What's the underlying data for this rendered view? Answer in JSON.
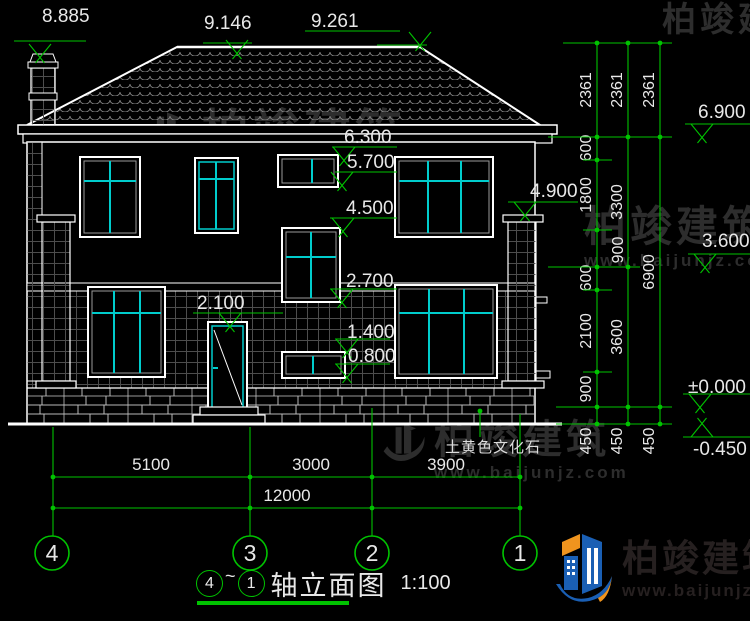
{
  "watermark": {
    "name": "柏竣建筑",
    "url": "www.baijunjz.com"
  },
  "logo": {
    "name": "柏竣建筑",
    "url": "www.baijunjz.com"
  },
  "title_block": {
    "axis_from": "4",
    "tilde": "~",
    "axis_to": "1",
    "title": "轴立面图",
    "scale": "1:100"
  },
  "material_label": {
    "text": "土黄色文化石"
  },
  "colors": {
    "dim_green": "#00c300",
    "line_white": "#e8e8e8",
    "window_cyan": "#00cccc",
    "logo_blue": "#1a5fb4",
    "logo_orange": "#f0941e"
  },
  "annotations": {
    "elevation_markers": [
      {
        "t": "8.885",
        "tx": 42,
        "ty": 6,
        "line": [
          14,
          86,
          41
        ],
        "apex": [
          40,
          57
        ]
      },
      {
        "t": "9.146",
        "tx": 204,
        "ty": 13,
        "line": [
          203,
          252,
          43
        ],
        "apex": [
          237,
          53
        ]
      },
      {
        "t": "9.261",
        "tx": 311,
        "ty": 11,
        "line": [
          305,
          400,
          31
        ],
        "line2": [
          377,
          427,
          45
        ],
        "apex": [
          420,
          45
        ]
      },
      {
        "t": "6.300",
        "tx": 344,
        "ty": 127,
        "line": [
          332,
          397,
          147
        ],
        "apex": [
          344,
          160
        ]
      },
      {
        "t": "5.700",
        "tx": 347,
        "ty": 152,
        "line": [
          335,
          397,
          172
        ],
        "apex": [
          342,
          185
        ]
      },
      {
        "t": "4.500",
        "tx": 346,
        "ty": 198,
        "line": [
          330,
          397,
          218
        ],
        "apex": [
          343,
          231
        ]
      },
      {
        "t": "2.700",
        "tx": 346,
        "ty": 271,
        "line": [
          330,
          397,
          289
        ],
        "apex": [
          342,
          302
        ]
      },
      {
        "t": "2.100",
        "tx": 197,
        "ty": 293,
        "line": [
          193,
          283,
          313
        ],
        "apex": [
          230,
          326
        ]
      },
      {
        "t": "1.400",
        "tx": 347,
        "ty": 322,
        "line": [
          335,
          390,
          339
        ],
        "apex": [
          347,
          352
        ]
      },
      {
        "t": "0.800",
        "tx": 348,
        "ty": 346,
        "line": [
          335,
          390,
          364
        ],
        "apex": [
          347,
          377
        ]
      },
      {
        "t": "4.900",
        "tx": 530,
        "ty": 181,
        "line": [
          508,
          578,
          202
        ],
        "apex": [
          525,
          215
        ]
      },
      {
        "t": "6.900",
        "tx": 698,
        "ty": 102,
        "line": [
          685,
          750,
          124
        ],
        "apex": [
          702,
          137
        ]
      },
      {
        "t": "3.600",
        "tx": 702,
        "ty": 231,
        "line": [
          688,
          750,
          254
        ],
        "apex": [
          705,
          267
        ]
      },
      {
        "t": "±0.000",
        "tx": 688,
        "ty": 377,
        "line": [
          683,
          750,
          394
        ],
        "apex": [
          700,
          407
        ]
      },
      {
        "t": "-0.450",
        "tx": 693,
        "ty": 439,
        "line": [
          683,
          750,
          437
        ],
        "apex": [
          702,
          424
        ],
        "up": true
      }
    ],
    "v_dim_columns": [
      {
        "x": 597,
        "y1": 43,
        "y2": 424,
        "ticks": [
          43,
          137,
          160,
          230,
          267,
          290,
          372,
          407,
          424
        ],
        "labels": [
          {
            "t": "2361",
            "cy": 90
          },
          {
            "t": "600",
            "cy": 148
          },
          {
            "t": "1800",
            "cy": 195
          },
          {
            "t": "900",
            "cy": 250,
            "dx": 32
          },
          {
            "t": "600",
            "cy": 278
          },
          {
            "t": "2100",
            "cy": 331
          },
          {
            "t": "900",
            "cy": 389
          },
          {
            "t": "450",
            "cy": 441
          }
        ]
      },
      {
        "x": 628,
        "y1": 43,
        "y2": 424,
        "ticks": [
          43,
          137,
          267,
          407,
          424
        ],
        "labels": [
          {
            "t": "2361",
            "cy": 90
          },
          {
            "t": "3300",
            "cy": 202
          },
          {
            "t": "3600",
            "cy": 337
          },
          {
            "t": "450",
            "cy": 441
          }
        ]
      },
      {
        "x": 660,
        "y1": 43,
        "y2": 424,
        "ticks": [
          43,
          137,
          407,
          424
        ],
        "labels": [
          {
            "t": "2361",
            "cy": 90
          },
          {
            "t": "6900",
            "cy": 272
          },
          {
            "t": "450",
            "cy": 441
          }
        ]
      }
    ],
    "v_dim_ext_lines": [
      [
        563,
        43,
        672,
        43
      ],
      [
        548,
        137,
        672,
        137
      ],
      [
        583,
        160,
        612,
        160
      ],
      [
        583,
        230,
        612,
        230
      ],
      [
        548,
        267,
        640,
        267
      ],
      [
        583,
        290,
        612,
        290
      ],
      [
        583,
        372,
        612,
        372
      ],
      [
        556,
        407,
        672,
        407
      ],
      [
        556,
        424,
        672,
        424
      ]
    ],
    "h_dim_rows": [
      {
        "y": 477,
        "x1": 53,
        "x2": 520,
        "ticks": [
          53,
          250,
          372,
          520
        ],
        "labels": [
          {
            "t": "5100",
            "cx": 151
          },
          {
            "t": "3000",
            "cx": 311
          },
          {
            "t": "3900",
            "cx": 446
          }
        ]
      },
      {
        "y": 508,
        "x1": 53,
        "x2": 520,
        "ticks": [
          53,
          250,
          372,
          520
        ],
        "labels": [
          {
            "t": "12000",
            "cx": 287
          }
        ]
      }
    ],
    "axis_ext_lines": [
      [
        53,
        427,
        53,
        536
      ],
      [
        250,
        427,
        250,
        536
      ],
      [
        372,
        408,
        372,
        536
      ],
      [
        520,
        414,
        520,
        536
      ]
    ],
    "leader": {
      "dot": [
        480,
        411
      ],
      "line": [
        480,
        411,
        480,
        437
      ]
    },
    "axes": [
      {
        "n": "4",
        "x": 52
      },
      {
        "n": "3",
        "x": 250
      },
      {
        "n": "2",
        "x": 372
      },
      {
        "n": "1",
        "x": 520
      }
    ],
    "axes_cy": 553,
    "axes_r": 17
  }
}
